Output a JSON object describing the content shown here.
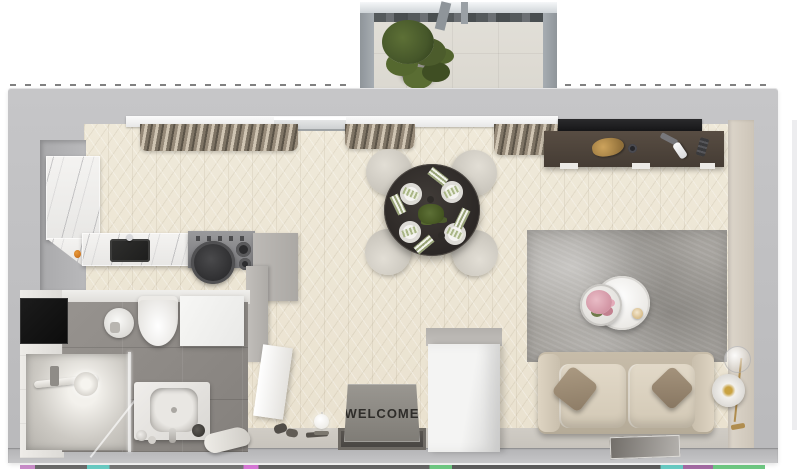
{
  "scene": {
    "title": "3D top-down floor plan render of a studio apartment",
    "mat_text": "WELCOME"
  },
  "palette": {
    "wall_gray": "#bfbfc1",
    "floor_wood": "#ece6d6",
    "bathroom_tile": "#8f8b87",
    "marble": "#f2f1ef",
    "sofa_beige": "#d8cfc0",
    "console_wood": "#4e443c",
    "table_dark": "#2f2b28",
    "rug_gray": "#a6a39e",
    "plant_green": "#4c5c2c",
    "mat_gray": "#8f8c87",
    "accent_gold": "#bd9a55"
  },
  "rooms": {
    "balcony": {
      "objects": [
        "potted-plant",
        "tile-floor",
        "glass-railing",
        "pergola-beams"
      ]
    },
    "kitchen": {
      "objects": [
        "l-shaped-marble-counter",
        "black-sink",
        "cooktop",
        "cooking-pan",
        "orange-fruit",
        "upper-curtain"
      ]
    },
    "dining": {
      "objects": [
        "round-dark-table",
        "four-cream-chairs",
        "four-place-settings",
        "striped-napkins",
        "green-centerpiece"
      ]
    },
    "living": {
      "objects": [
        "wall-tv",
        "dark-media-console",
        "cat",
        "remote",
        "area-rug",
        "round-coffee-tables",
        "pink-flower-bouquet",
        "beige-sofa",
        "two-throw-pillows",
        "arc-floor-lamp",
        "floor-art"
      ]
    },
    "bathroom": {
      "objects": [
        "black-niche",
        "corner-basin",
        "wall-hung-toilet",
        "washing-machine",
        "glass-shower",
        "shower-head",
        "vanity-basin",
        "towel"
      ]
    },
    "hallway": {
      "objects": [
        "welcome-mat",
        "entry-threshold",
        "white-wardrobe",
        "open-white-door",
        "shoes",
        "ball-floor-lamp"
      ]
    }
  },
  "windows": {
    "objects": [
      "window-sill",
      "balcony-door-track",
      "curtain-left",
      "curtain-middle",
      "curtain-right"
    ]
  }
}
